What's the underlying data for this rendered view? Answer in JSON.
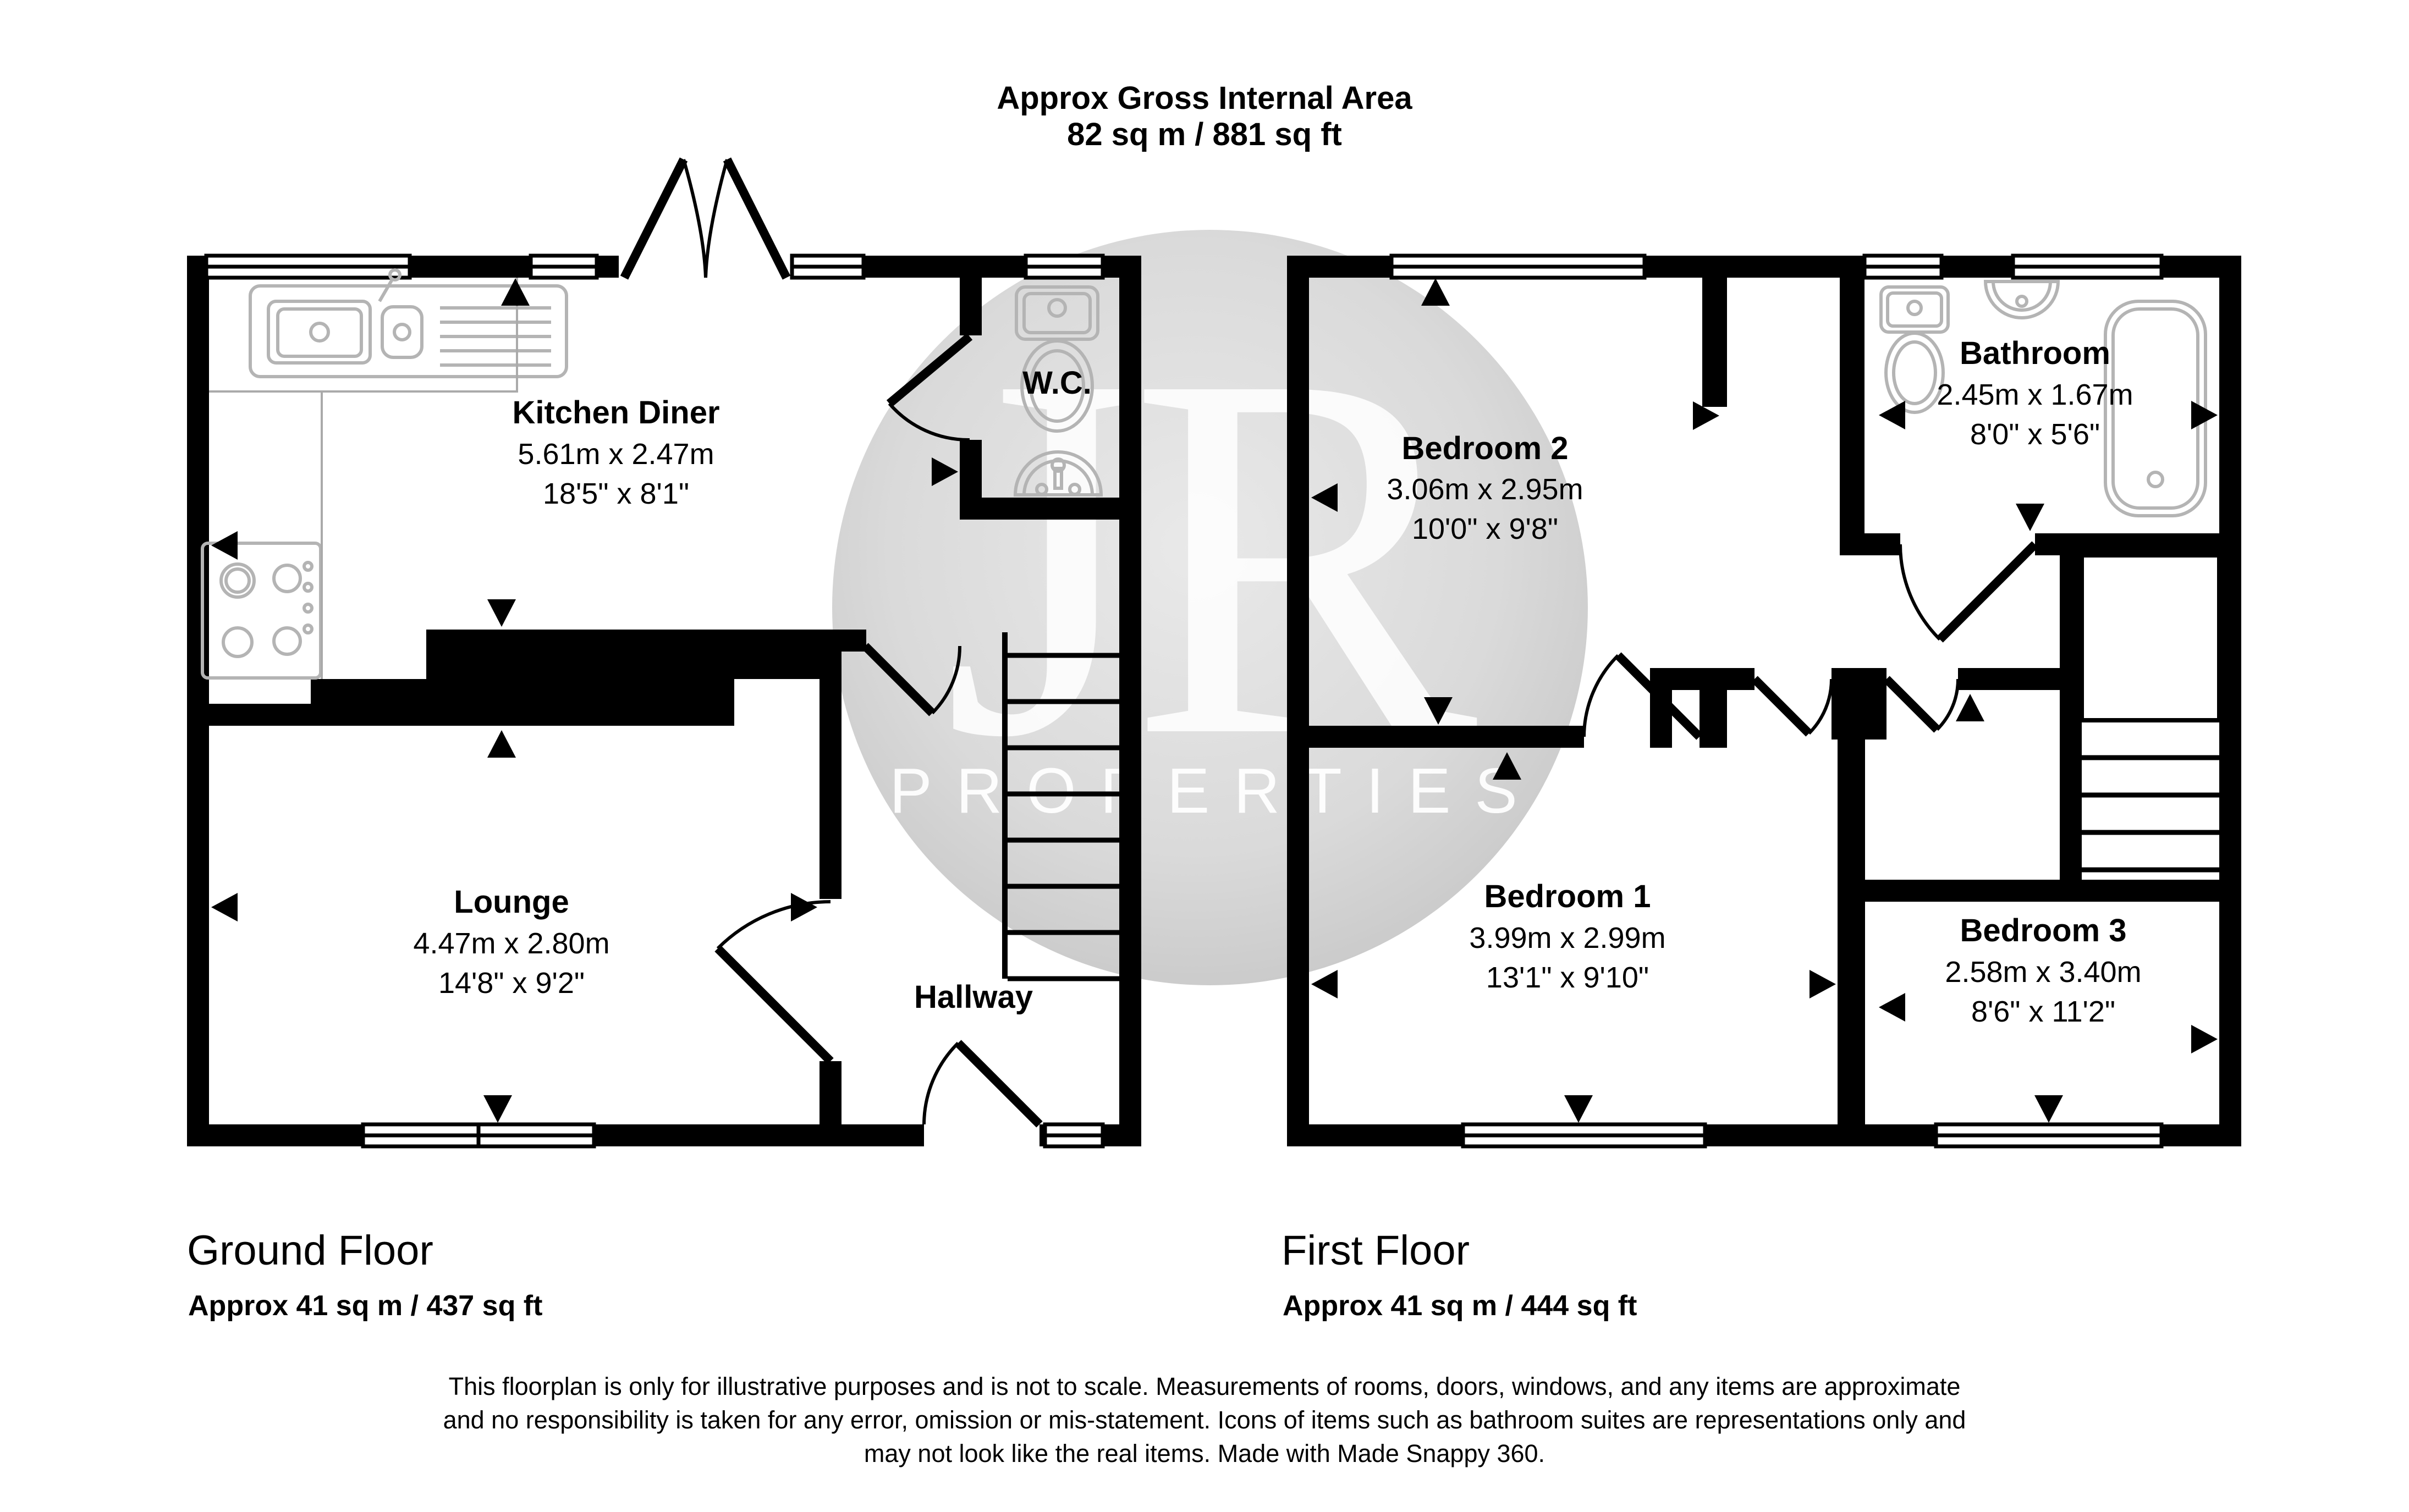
{
  "header": {
    "title": "Approx Gross Internal Area",
    "area": "82 sq m / 881 sq ft"
  },
  "watermark": {
    "monogram": "JR",
    "word": "PROPERTIES"
  },
  "ground_floor": {
    "label": "Ground Floor",
    "area": "Approx 41 sq m / 437 sq ft",
    "rooms": {
      "kitchen_diner": {
        "name": "Kitchen Diner",
        "metric": "5.61m x 2.47m",
        "imperial": "18'5\" x 8'1\""
      },
      "wc": {
        "name": "W.C."
      },
      "lounge": {
        "name": "Lounge",
        "metric": "4.47m x 2.80m",
        "imperial": "14'8\" x 9'2\""
      },
      "hallway": {
        "name": "Hallway"
      }
    }
  },
  "first_floor": {
    "label": "First Floor",
    "area": "Approx 41 sq m / 444 sq ft",
    "rooms": {
      "bedroom2": {
        "name": "Bedroom 2",
        "metric": "3.06m x 2.95m",
        "imperial": "10'0\" x 9'8\""
      },
      "bathroom": {
        "name": "Bathroom",
        "metric": "2.45m x 1.67m",
        "imperial": "8'0\" x 5'6\""
      },
      "bedroom1": {
        "name": "Bedroom 1",
        "metric": "3.99m x 2.99m",
        "imperial": "13'1\" x 9'10\""
      },
      "bedroom3": {
        "name": "Bedroom 3",
        "metric": "2.58m x 3.40m",
        "imperial": "8'6\" x 11'2\""
      }
    }
  },
  "disclaimer": {
    "line1": "This floorplan is only for illustrative purposes and is not to scale. Measurements of rooms, doors, windows, and any items are approximate",
    "line2": "and no responsibility is taken for any error, omission or mis-statement. Icons of items such as bathroom suites are representations only and",
    "line3": "may not look like the real items. Made with Made Snappy 360."
  },
  "colors": {
    "wall": "#000000",
    "fixture": "#b4b4b4",
    "watermark_circle": "#d7d7d7",
    "watermark_text": "#ffffff",
    "background": "#ffffff"
  }
}
